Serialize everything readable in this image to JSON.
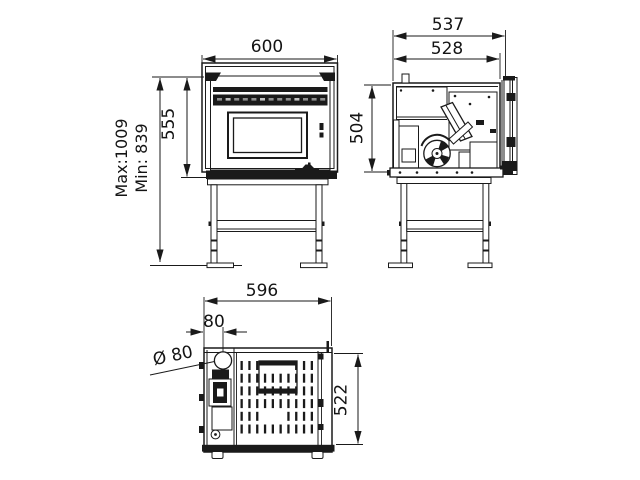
{
  "drawing": {
    "title": "pellet-stove-three-view-technical-drawing",
    "views": {
      "front": {
        "label": "front view",
        "dims": {
          "width": "600",
          "body_height": "555",
          "max_total_height": "Max:1009",
          "min_total_height": "Min: 839"
        }
      },
      "side": {
        "label": "side view",
        "dims": {
          "depth_overall": "537",
          "depth_body": "528",
          "body_height": "504"
        }
      },
      "top": {
        "label": "top view",
        "dims": {
          "width": "596",
          "flue_offset": "80",
          "flue_diameter": "Ø 80",
          "depth": "522"
        }
      }
    }
  }
}
